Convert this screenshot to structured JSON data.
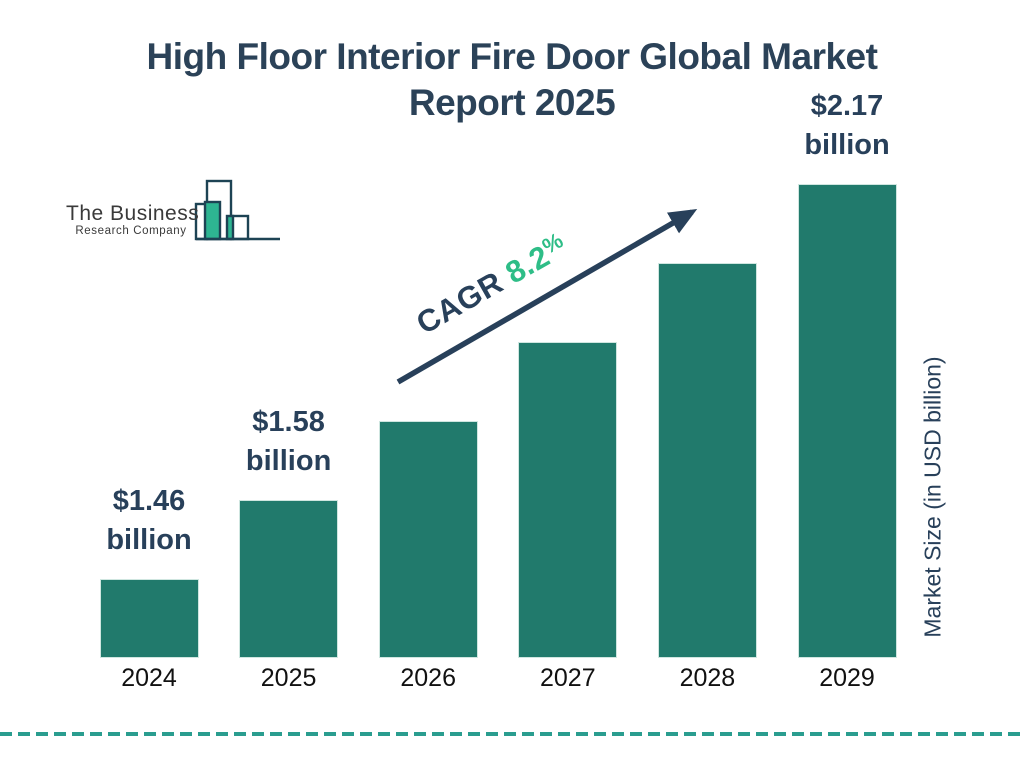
{
  "header": {
    "title_line1": "High Floor Interior Fire Door Global Market",
    "title_line2": "Report 2025"
  },
  "logo": {
    "name": "The Business",
    "tagline": "Research Company"
  },
  "annotations": {
    "cagr_label": "CAGR",
    "cagr_value": " 8.2",
    "cagr_unit": "%"
  },
  "colors": {
    "navy_text": "#2b4258",
    "bar_fill": "#217a6c",
    "accent_green": "#2ebd87",
    "logo_green": "#2eb592",
    "dashed_rule": "#2a9d8f",
    "year_text": "#111111"
  },
  "chart_data": {
    "type": "bar",
    "title": "High Floor Interior Fire Door Global Market Report 2025",
    "categories": [
      "2024",
      "2025",
      "2026",
      "2027",
      "2028",
      "2029"
    ],
    "bar_heights_px": [
      79,
      158,
      237,
      316,
      395,
      474
    ],
    "value_labels": [
      {
        "category": "2024",
        "amount": "$1.46",
        "unit": "billion"
      },
      {
        "category": "2025",
        "amount": "$1.58",
        "unit": "billion"
      },
      {
        "category": "2029",
        "amount": "$2.17",
        "unit": "billion"
      }
    ],
    "ylabel": "Market Size (in USD billion)",
    "cagr_annotation": "CAGR 8.2%",
    "grid": false,
    "legend_position": "none"
  }
}
